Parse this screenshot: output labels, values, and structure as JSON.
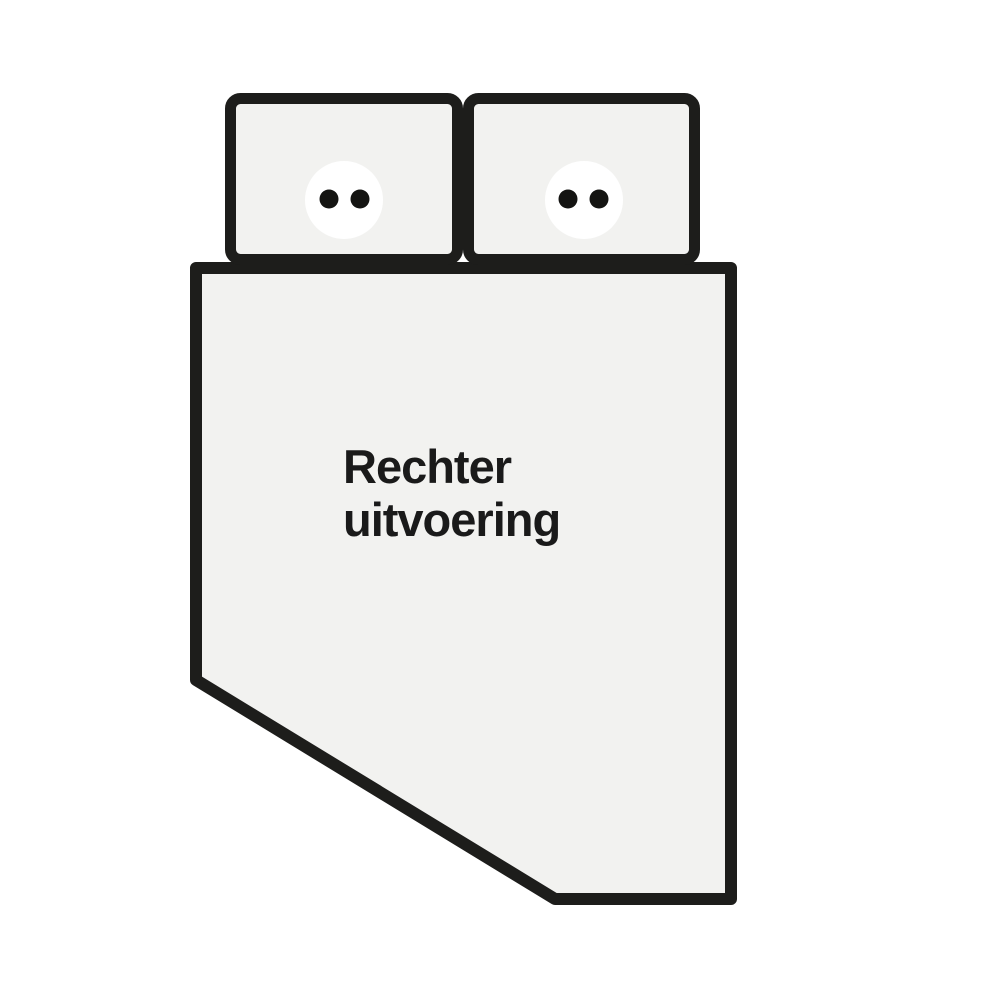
{
  "diagram": {
    "label": {
      "line1": "Rechter",
      "line2": "uitvoering",
      "full": "Rechter uitvoering"
    },
    "colors": {
      "background": "#ffffff",
      "outline": "#1d1d1b",
      "surface": "#f2f2f0",
      "pillow_face": "#ffffff",
      "dot": "#141412",
      "text": "#1a1a1a"
    }
  }
}
